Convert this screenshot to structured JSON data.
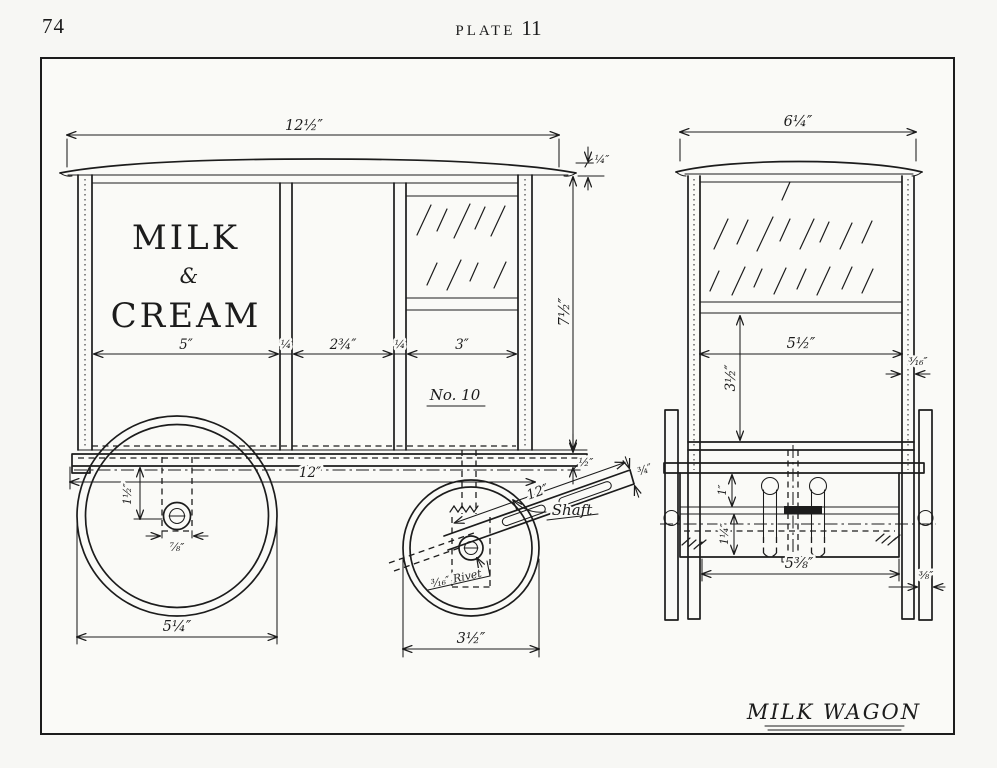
{
  "page": {
    "number": "74",
    "plate_word": "PLATE",
    "plate_number": "11"
  },
  "side_view": {
    "signage_line1": "MILK",
    "signage_amp": "&",
    "signage_line2": "CREAM",
    "model_no": "No. 10",
    "shaft_label": "Shaft",
    "rivet_note": "³⁄₁₆″ Rivet",
    "dim_overall_width": "12½″",
    "dim_roof_thickness": "¼″",
    "dim_body_height": "7½″",
    "dim_floor_thickness": "½″",
    "dim_left_panel": "5″",
    "dim_left_stile": "¼",
    "dim_door_panel": "2¾″",
    "dim_right_stile": "¼",
    "dim_right_panel": "3″",
    "dim_floor_length": "12″",
    "dim_rear_wheel_dia": "5¼″",
    "dim_front_wheel_dia": "3½″",
    "dim_hub_offset": "1½″",
    "dim_hub_width": "⅞″",
    "dim_shaft_length": "12″",
    "dim_shaft_width": "¾″"
  },
  "front_view": {
    "dim_overall_width": "6¼″",
    "dim_inner_width": "5½″",
    "dim_inner_height": "3½″",
    "dim_post_thickness": "³⁄₁₆″",
    "dim_spring_height": "1″",
    "dim_axle_depth": "1¼″",
    "dim_frame_width": "5⅜″",
    "dim_wheel_width": "⅜″"
  },
  "title": "MILK WAGON",
  "colors": {
    "ink": "#1c1c1c",
    "paper": "#fafaf7"
  }
}
